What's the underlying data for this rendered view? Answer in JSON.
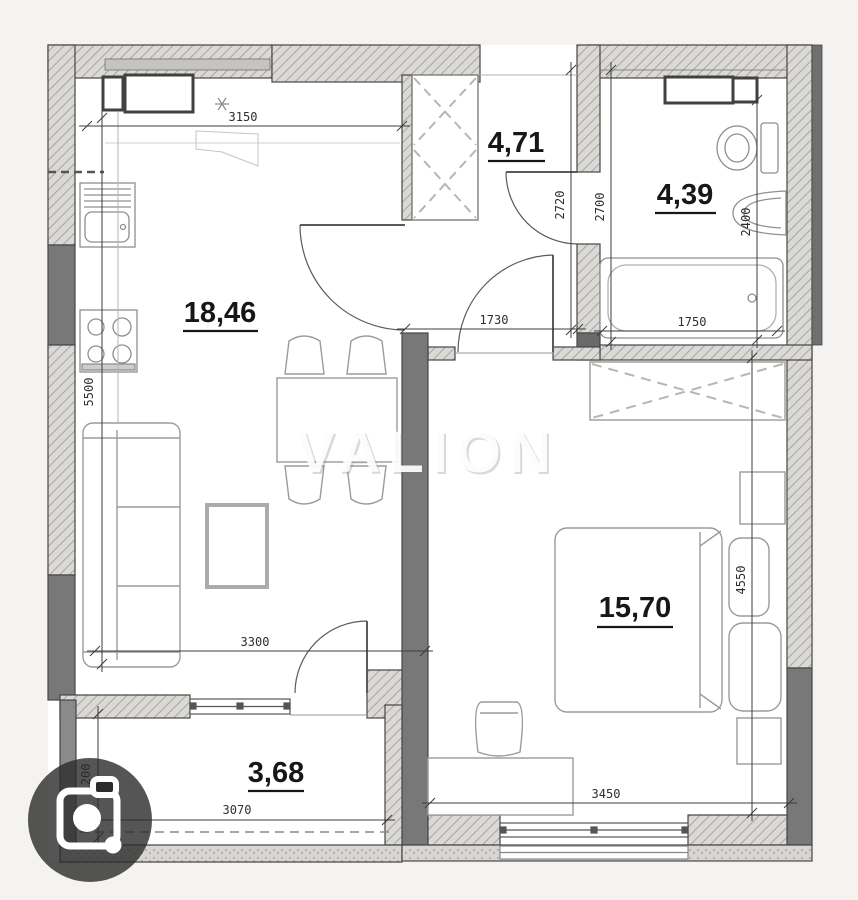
{
  "watermark": {
    "text": "VALION"
  },
  "rooms": {
    "living_kitchen": {
      "area": "18,46"
    },
    "hallway": {
      "area": "4,71"
    },
    "bathroom": {
      "area": "4,39"
    },
    "bedroom": {
      "area": "15,70"
    },
    "balcony": {
      "area": "3,68"
    }
  },
  "dimensions_mm": {
    "kitchen_window_width": "3150",
    "hallway_depth": "2720",
    "bathroom_depth": "2700",
    "bathroom_inner_depth": "2400",
    "corridor_opening": "1730",
    "bathroom_width": "1750",
    "living_depth": "5500",
    "living_width": "3300",
    "bedroom_depth": "4550",
    "bedroom_width": "3450",
    "balcony_width": "3070",
    "balcony_depth": "1200"
  },
  "colors": {
    "wall_hatch_bg": "#dbd9d6",
    "wall_hatch_line": "#a7a5a1",
    "wall_solid": "#787878",
    "outline": "#454545",
    "furniture_stroke": "#9b9b9b",
    "watermark_fill": "#ffffff",
    "camera_badge_bg": "#2b2b2b"
  }
}
